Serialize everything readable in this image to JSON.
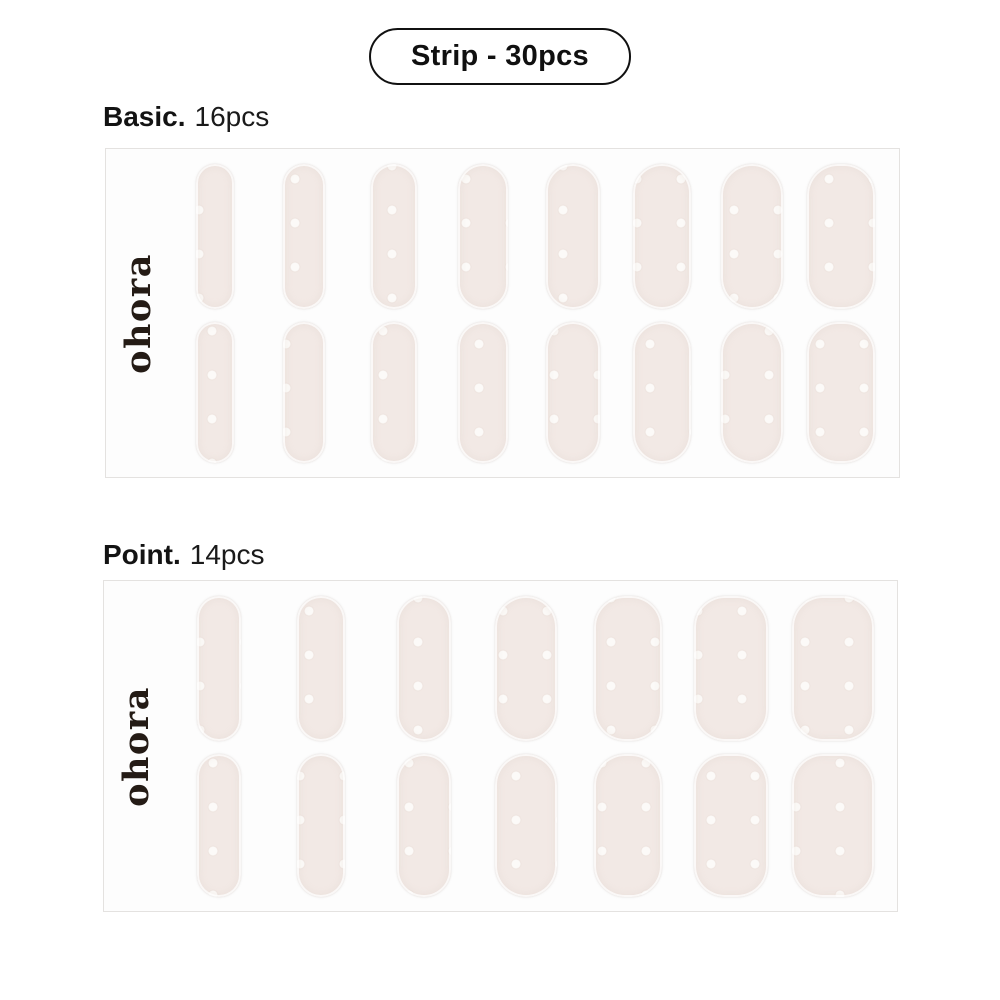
{
  "badge": {
    "label": "Strip - 30pcs"
  },
  "brand": {
    "logo_text": "ohora"
  },
  "colors": {
    "page_bg": "#ffffff",
    "sheet_bg": "#fdfdfd",
    "sheet_border": "#e4e2e0",
    "strip_fill": "#f2e9e5",
    "strip_dot": "#fcfaf8",
    "label_text": "#131313",
    "logo_text_color": "#241b15",
    "badge_border": "#111111"
  },
  "sheets": [
    {
      "title": "Basic.",
      "count_label": "16pcs",
      "rows": 2,
      "strip_widths": [
        38,
        42,
        46,
        50,
        54,
        58,
        62,
        68
      ],
      "row_heights": [
        145,
        141
      ]
    },
    {
      "title": "Point.",
      "count_label": "14pcs",
      "rows": 2,
      "strip_widths": [
        44,
        48,
        54,
        62,
        68,
        74,
        82
      ],
      "row_heights": [
        145,
        143
      ]
    }
  ]
}
